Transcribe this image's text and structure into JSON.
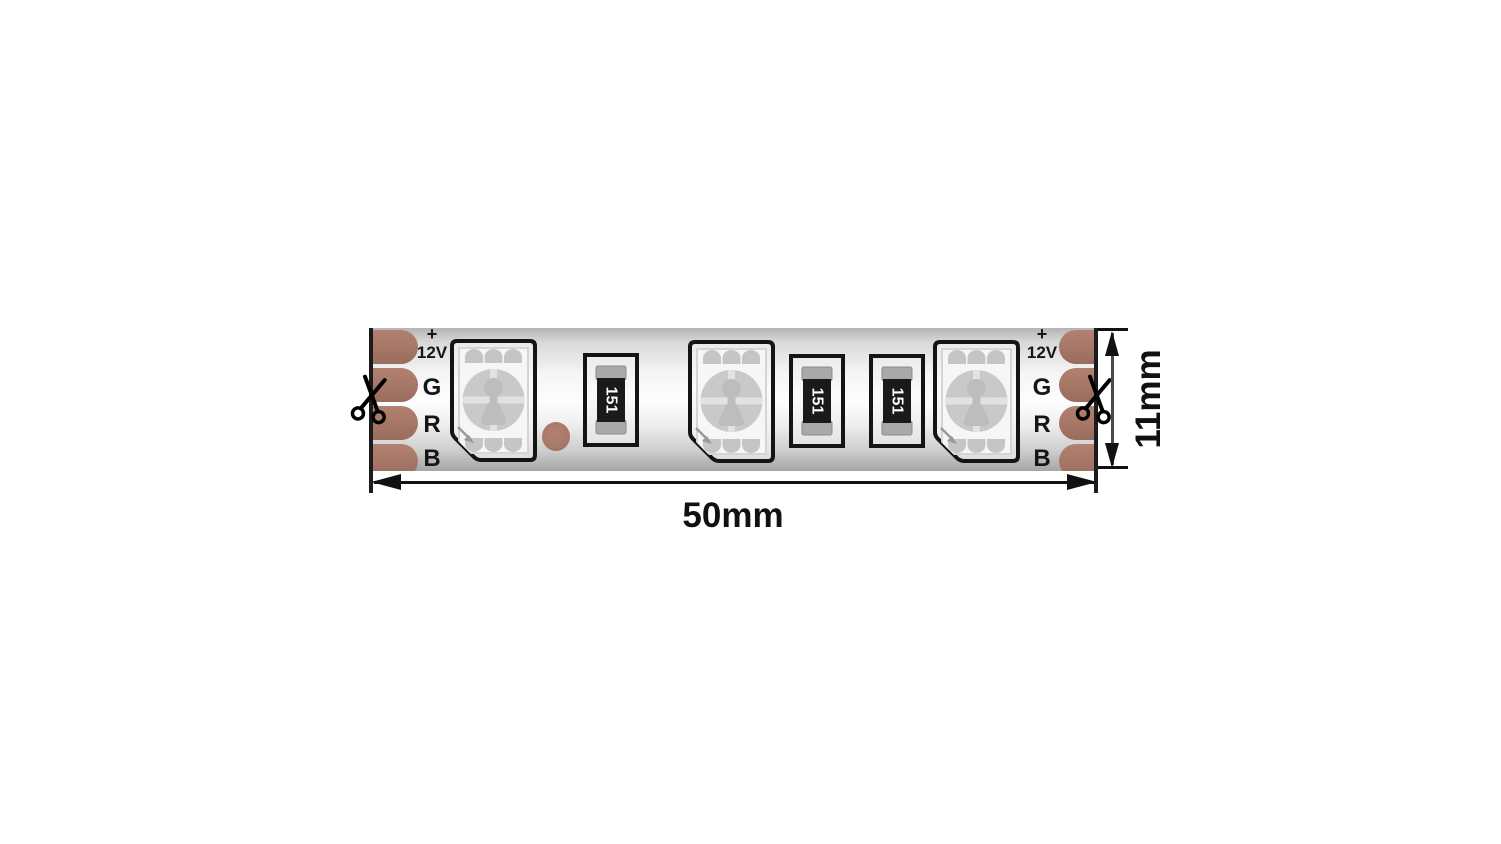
{
  "terminals": {
    "plus": "+",
    "power": "12V",
    "green": "G",
    "red": "R",
    "blue": "B"
  },
  "resistor": {
    "code": "151"
  },
  "dimensions": {
    "width": "50mm",
    "height": "11mm"
  },
  "icons": {
    "cut_mark_left": "scissors",
    "cut_mark_right": "scissors"
  },
  "colors": {
    "copper": "#a87868",
    "outline": "#141414",
    "dimension": "#111111",
    "strip_highlight": "#fdfdfd",
    "strip_shadow": "#a5a5a5"
  }
}
